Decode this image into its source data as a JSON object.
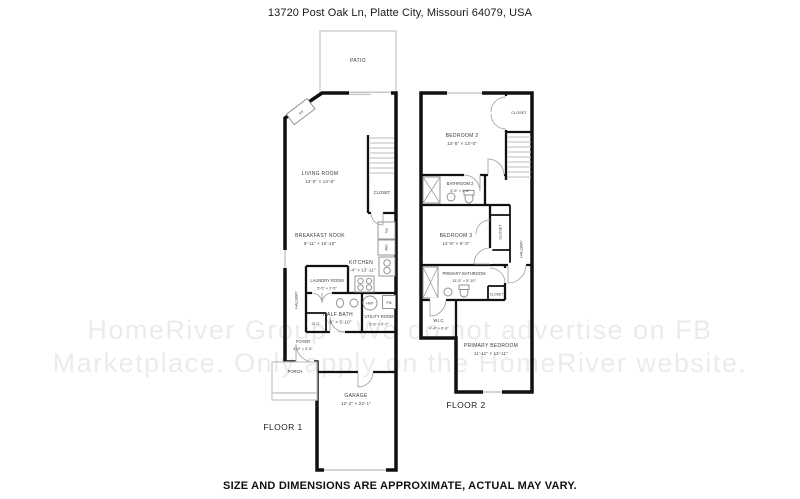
{
  "meta": {
    "address": "13720 Post Oak Ln, Platte City, Missouri 64079, USA",
    "disclaimer": "SIZE AND DIMENSIONS ARE APPROXIMATE, ACTUAL MAY VARY."
  },
  "watermark": {
    "line1": "HomeRiver Group - We do not advertise on FB",
    "line2": "Marketplace. Only apply on the HomeRiver website."
  },
  "floor1": {
    "label": "FLOOR 1",
    "rooms": {
      "patio": {
        "name": "PATIO"
      },
      "living_room": {
        "name": "LIVING ROOM",
        "dims": "13'-0\" × 13'-6\""
      },
      "closet": {
        "name": "CLOSET"
      },
      "breakfast_nook": {
        "name": "BREAKFAST NOOK",
        "dims": "9'-11\" × 10'-10\""
      },
      "kitchen": {
        "name": "KITCHEN",
        "dims": "7'-4\" × 13'-11\""
      },
      "laundry_room": {
        "name": "LAUNDRY ROOM",
        "dims": "5'-5\" × 2'-5\""
      },
      "hallway": {
        "name": "HALLWAY"
      },
      "half_bath": {
        "name": "HALF BATH",
        "dims": "7'-5\" × 5'-10\""
      },
      "closet_small": {
        "name": "CLO."
      },
      "utility_room": {
        "name": "UTILITY ROOM",
        "dims": "5'-6\" × 5'-7\""
      },
      "foyer": {
        "name": "FOYER",
        "dims": "4'-9\" × 3'-5\""
      },
      "porch": {
        "name": "PORCH"
      },
      "garage": {
        "name": "GARAGE",
        "dims": "12'-2\" × 22'-1\""
      }
    },
    "fixtures": {
      "fireplace": "FP",
      "fridge": "FR",
      "dishwasher": "DW",
      "water_heater": "HWT",
      "furnace": "FN"
    }
  },
  "floor2": {
    "label": "FLOOR 2",
    "rooms": {
      "bedroom_2": {
        "name": "BEDROOM 2",
        "dims": "13'-5\" × 13'-0\""
      },
      "closet_bedroom_2": {
        "name": "CLOSET"
      },
      "bathroom_2": {
        "name": "BATHROOM 2",
        "dims": "9'-5\" × 4'-6\""
      },
      "bedroom_3": {
        "name": "BEDROOM 3",
        "dims": "13'-5\" × 9'-3\""
      },
      "closet_bedroom_3": {
        "name": "CLOSET"
      },
      "hallway": {
        "name": "HALLWAY"
      },
      "primary_bathroom": {
        "name": "PRIMARY BATHROOM",
        "dims": "13'-5\" × 5'-10\""
      },
      "closet_primary": {
        "name": "CLOSET"
      },
      "wic": {
        "name": "W.I.C.",
        "dims": "4'-4\" × 6'-6\""
      },
      "primary_bedroom": {
        "name": "PRIMARY BEDROOM",
        "dims": "11'-11\" × 13'-11\""
      }
    }
  },
  "colors": {
    "wall": "#111111",
    "light_outline": "#c9c9c9",
    "watermark_text": "rgba(0,0,0,0.08)"
  }
}
